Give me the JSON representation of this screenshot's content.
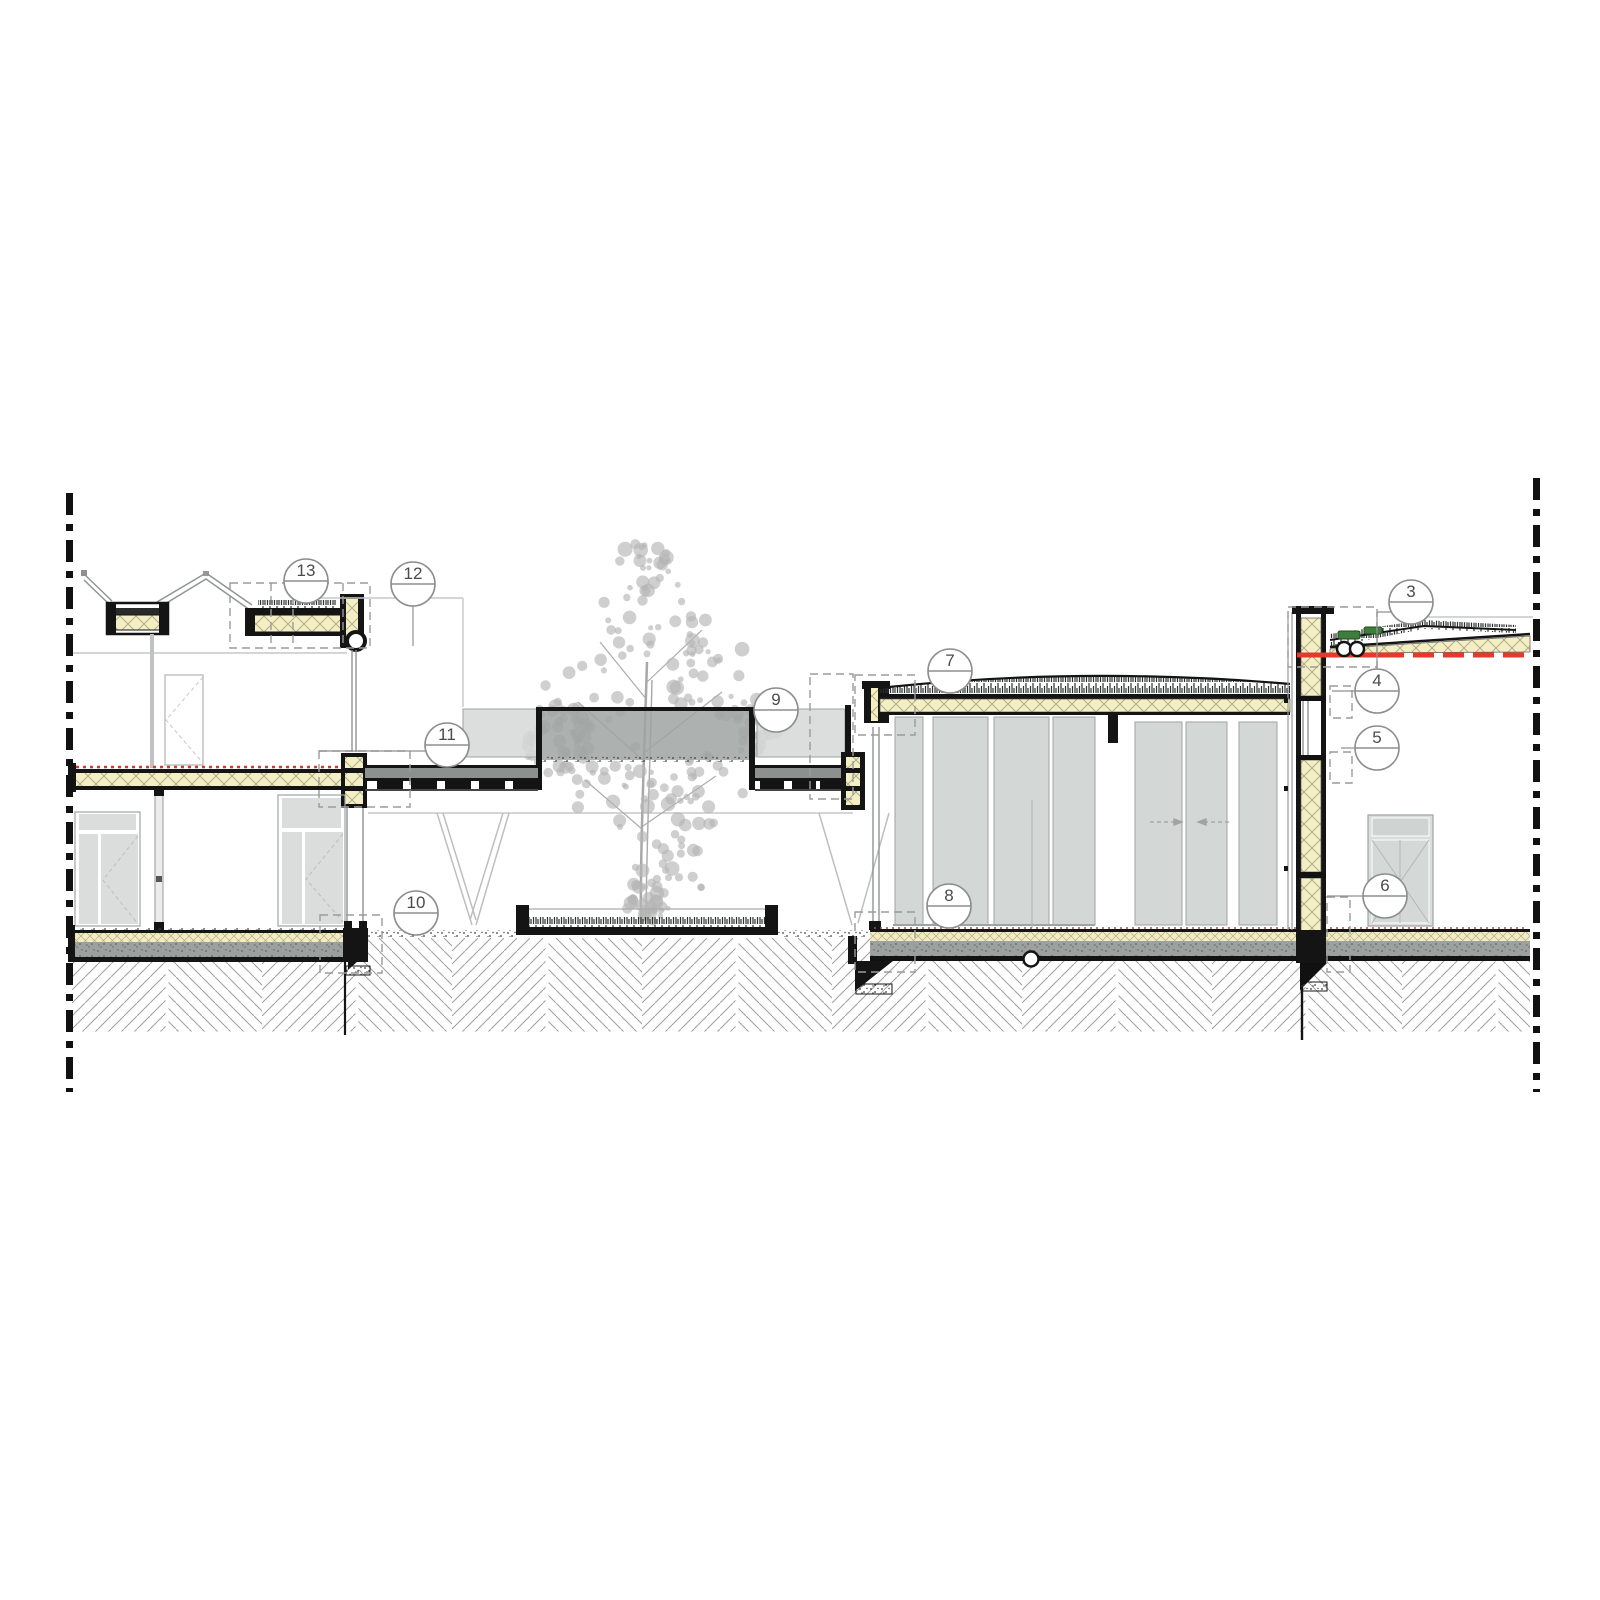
{
  "drawing": {
    "type": "architectural-long-section-detail",
    "callouts": {
      "c3": "3",
      "c4": "4",
      "c5": "5",
      "c6": "6",
      "c7": "7",
      "c8": "8",
      "c9": "9",
      "c10": "10",
      "c11": "11",
      "c12": "12",
      "c13": "13"
    },
    "colors": {
      "insulation_yellow": "#f4eec3",
      "screed_gray": "#9ca19f",
      "glass_gray": "#d3d7d6",
      "band_dark_gray": "#9fa3a2",
      "tree_gray": "#b3b5b3",
      "green_roof_plant": "#3f7d3f",
      "barrier_red_line": "#e6392d",
      "linework_black": "#141414",
      "boundary_black": "#111111"
    }
  }
}
